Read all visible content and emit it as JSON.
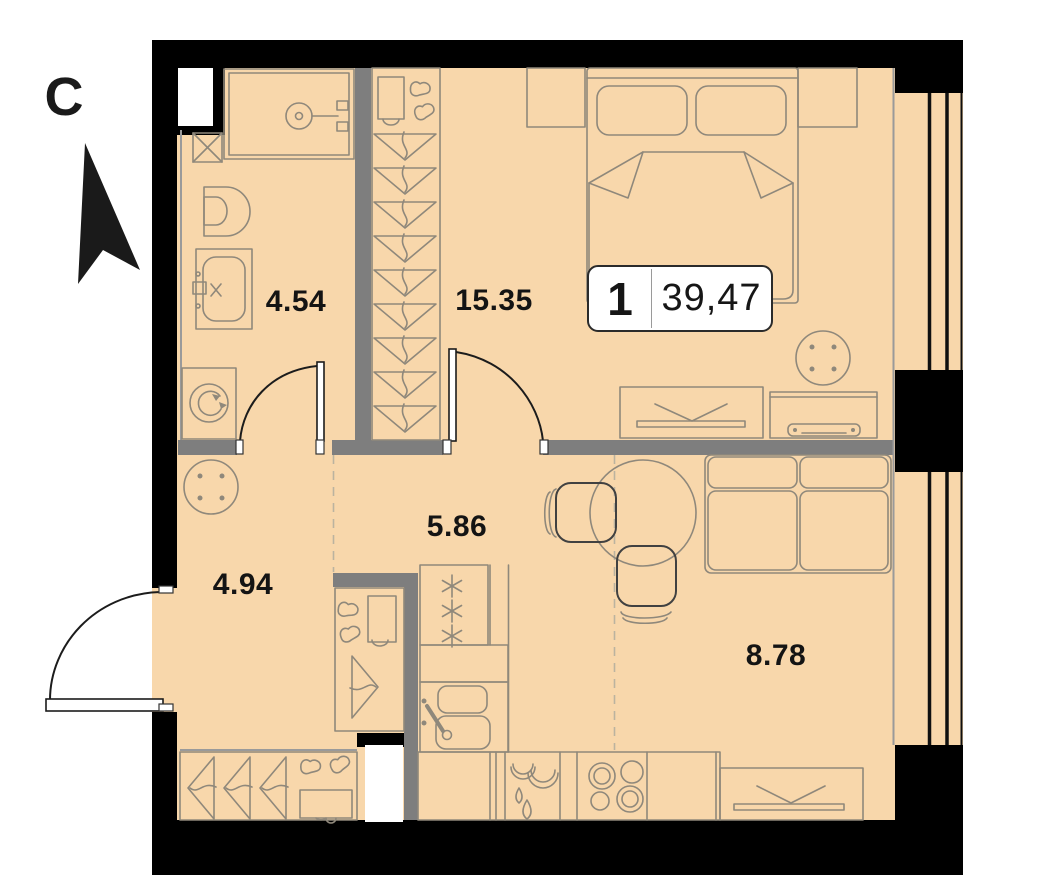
{
  "plan": {
    "compass": {
      "letter": "C"
    },
    "badge": {
      "rooms": "1",
      "area": "39,47"
    },
    "rooms": [
      {
        "id": "bathroom",
        "area": "4.54"
      },
      {
        "id": "bedroom",
        "area": "15.35"
      },
      {
        "id": "corridor",
        "area": "5.86"
      },
      {
        "id": "hallway",
        "area": "4.94"
      },
      {
        "id": "living-kitchen",
        "area": "8.78"
      }
    ],
    "colors": {
      "floor": "#f8d7ab",
      "wall": "#000000",
      "partition": "#7e7e7e",
      "furniture_line": "#8f887b",
      "label_text": "#141414",
      "badge_bg": "#ffffff",
      "badge_border": "#2b2b2b"
    }
  }
}
